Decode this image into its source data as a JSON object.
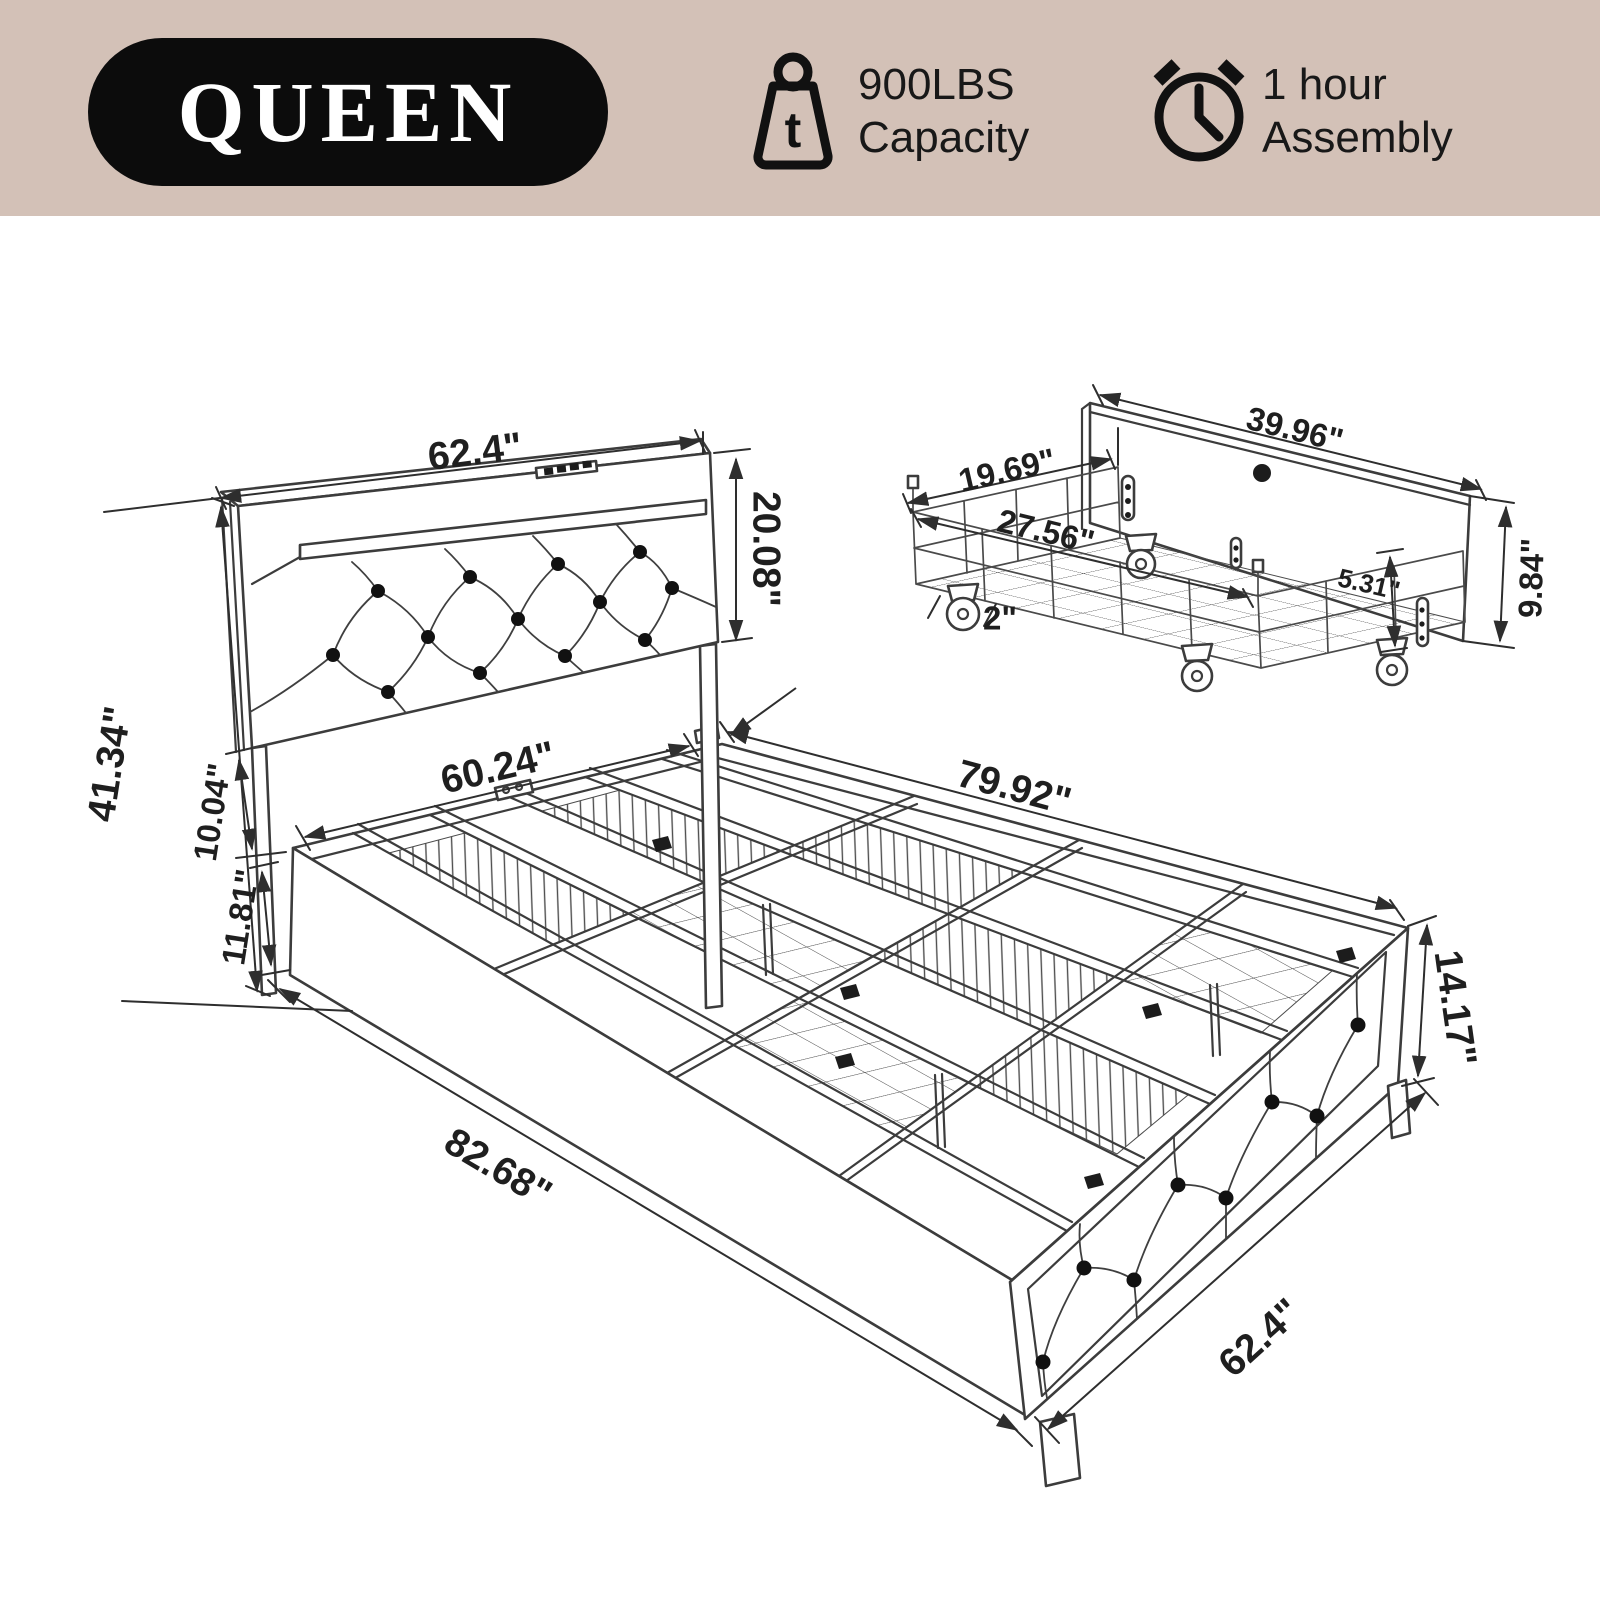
{
  "banner": {
    "size_label": "QUEEN",
    "capacity": {
      "icon_letter": "t",
      "line1": "900LBS",
      "line2": "Capacity"
    },
    "assembly": {
      "line1": "1 hour",
      "line2": "Assembly"
    }
  },
  "dims": {
    "headboard_width": "62.4\"",
    "headboard_panel_height": "20.08\"",
    "headboard_total_height": "41.34\"",
    "headboard_gap": "10.04\"",
    "side_rail_height": "11.81\"",
    "inner_width": "60.24\"",
    "frame_length": "79.92\"",
    "total_length": "82.68\"",
    "frame_width": "62.4\"",
    "footboard_height": "14.17\""
  },
  "drawer": {
    "front_width": "39.96\"",
    "depth": "19.69\"",
    "basket_width": "27.56\"",
    "front_height": "9.84\"",
    "inner_height": "5.31\"",
    "caster_size": "2\""
  },
  "colors": {
    "banner_bg": "#d3c1b7",
    "pill_bg": "#0c0c0c",
    "pill_text": "#ffffff",
    "line": "#3c3c3c",
    "text": "#1f1f1f"
  }
}
